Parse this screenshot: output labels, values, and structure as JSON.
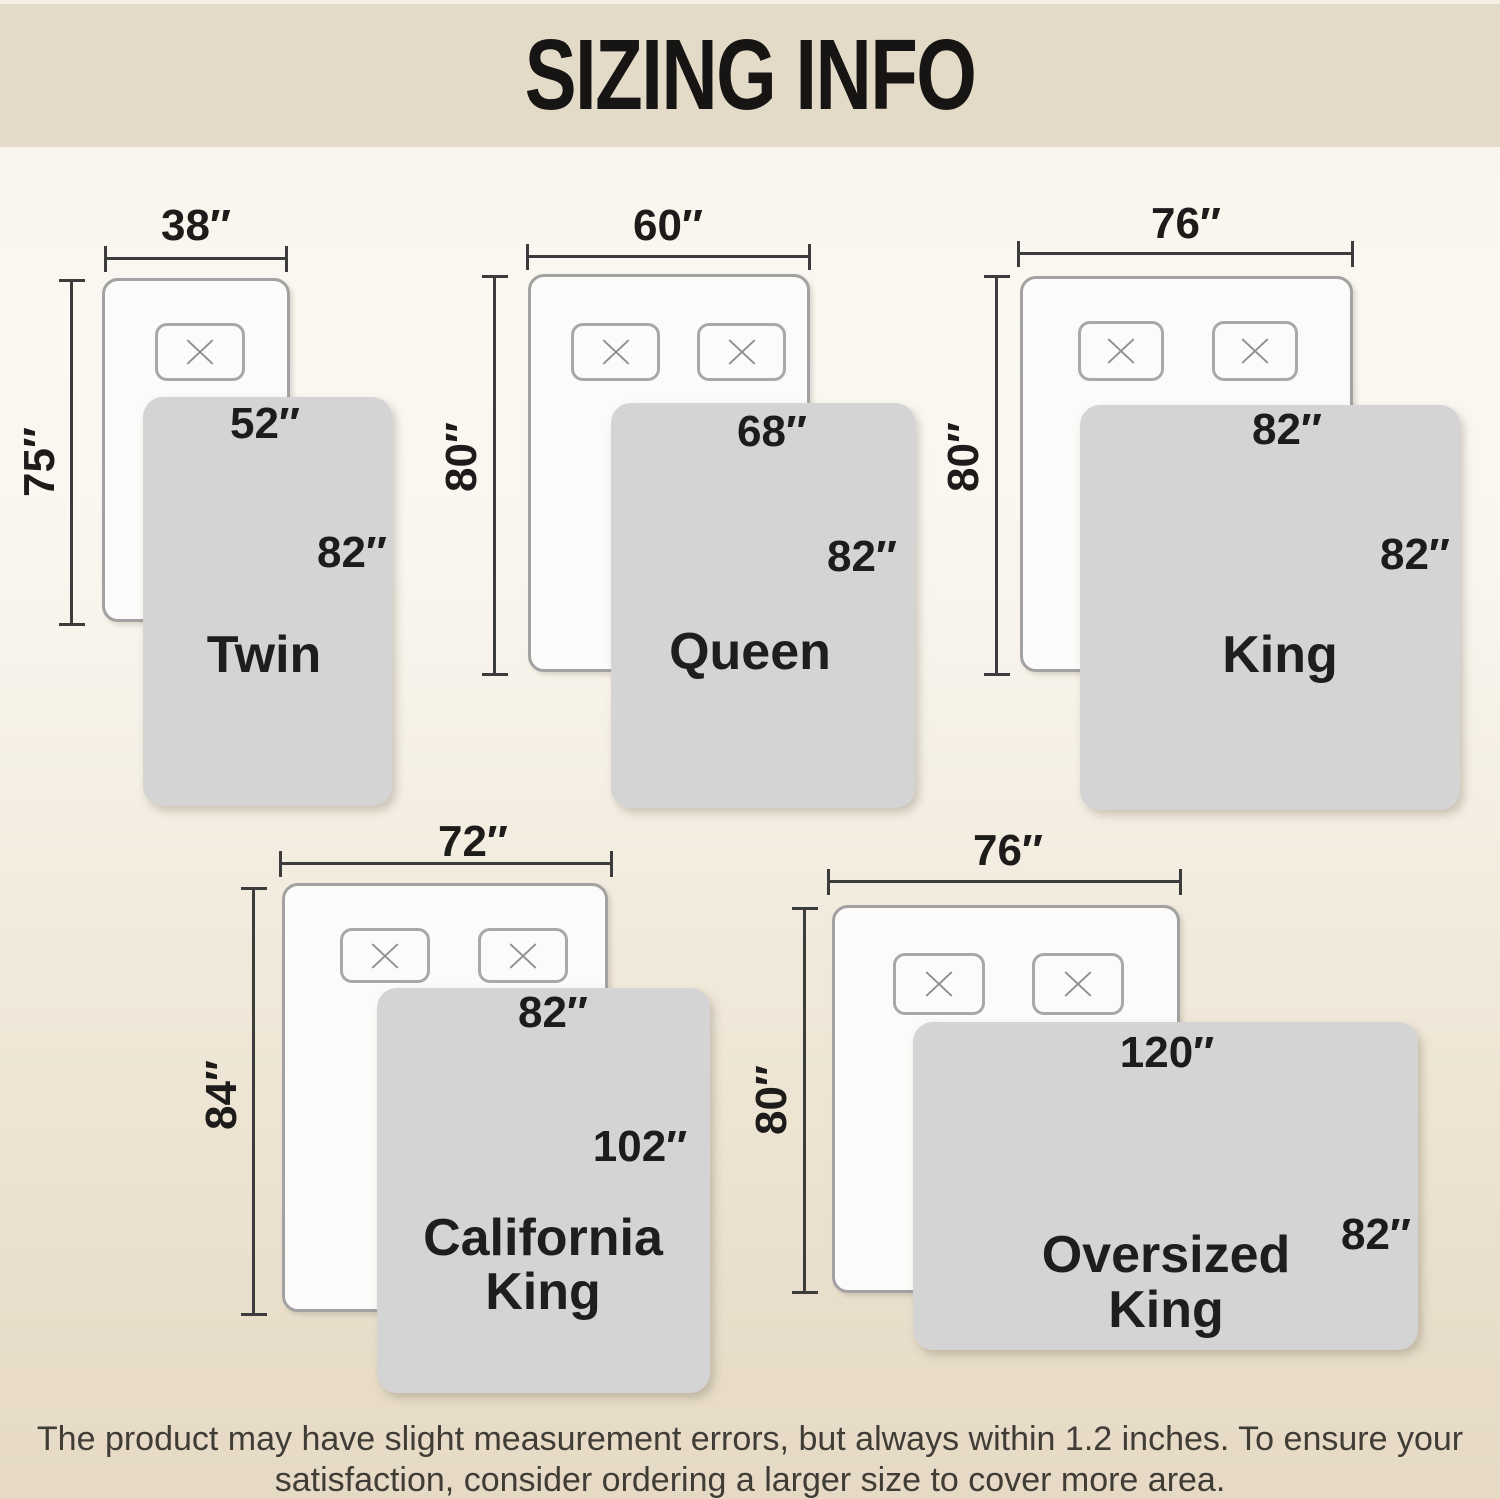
{
  "header": {
    "title": "SIZING INFO"
  },
  "sizes": [
    {
      "name_lines": [
        "Twin"
      ],
      "bed_width": "38″",
      "bed_length": "75″",
      "blanket_width": "52″",
      "blanket_length": "82″"
    },
    {
      "name_lines": [
        "Queen"
      ],
      "bed_width": "60″",
      "bed_length": "80″",
      "blanket_width": "68″",
      "blanket_length": "82″"
    },
    {
      "name_lines": [
        "King"
      ],
      "bed_width": "76″",
      "bed_length": "80″",
      "blanket_width": "82″",
      "blanket_length": "82″"
    },
    {
      "name_lines": [
        "California",
        "King"
      ],
      "bed_width": "72″",
      "bed_length": "84″",
      "blanket_width": "82″",
      "blanket_length": "102″"
    },
    {
      "name_lines": [
        "Oversized",
        "King"
      ],
      "bed_width": "76″",
      "bed_length": "80″",
      "blanket_width": "120″",
      "blanket_length": "82″"
    }
  ],
  "footer": {
    "line1": "The product may have slight measurement errors, but always within 1.2 inches. To ensure your",
    "line2": "satisfaction, consider ordering a larger size to cover more area."
  },
  "colors": {
    "header_bg": "#e4dac8",
    "page_bottom_bg": "#e6dac5",
    "blanket_gray": "#d4d4d4",
    "bed_white": "#fcfbf9",
    "outline_gray": "#a2a2a2",
    "dimension_line": "#3c3c3c",
    "text_black": "#1d1c1a"
  }
}
